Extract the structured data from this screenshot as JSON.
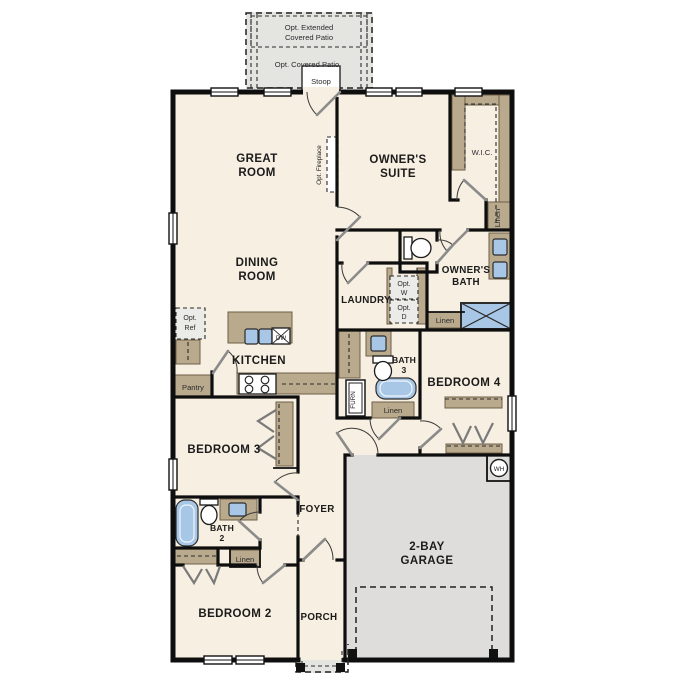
{
  "colors": {
    "interior": "#f7efe1",
    "patio": "#e4e4e1",
    "garage": "#dedddb",
    "tan": "#b9a98d",
    "blue": "#a8c7e7",
    "lightbox": "#ebebe8",
    "wall": "#111111"
  },
  "labels": {
    "patio_ext1": "Opt. Extended",
    "patio_ext2": "Covered Patio",
    "patio_cov": "Opt. Covered Patio",
    "stoop": "Stoop",
    "great1": "GREAT",
    "great2": "ROOM",
    "fireplace": "Opt. Fireplace",
    "suite1": "OWNER'S",
    "suite2": "SUITE",
    "wic": "W.I.C.",
    "linen": "Linen",
    "obath1": "OWNER'S",
    "obath2": "BATH",
    "laundry": "LAUNDRY",
    "optw1": "Opt.",
    "optw2": "W",
    "optd1": "Opt.",
    "optd2": "D",
    "dining1": "DINING",
    "dining2": "ROOM",
    "kitchen": "KITCHEN",
    "dw": "DW",
    "optref1": "Opt.",
    "optref2": "Ref",
    "pantry": "Pantry",
    "bath3a": "BATH",
    "bath3b": "3",
    "bedroom4": "BEDROOM 4",
    "furn": "FURN",
    "bedroom3": "BEDROOM 3",
    "foyer": "FOYER",
    "bath2a": "BATH",
    "bath2b": "2",
    "bedroom2": "BEDROOM 2",
    "porch": "PORCH",
    "garage1": "2-BAY",
    "garage2": "GARAGE",
    "wh": "WH"
  }
}
